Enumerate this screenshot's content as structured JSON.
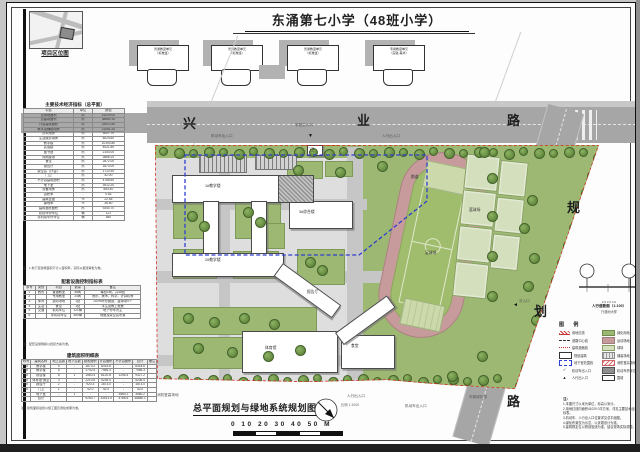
{
  "page_title": "东涌第七小学（48班小学）",
  "location_map": {
    "caption": "项目区位图"
  },
  "roads": {
    "xingye": [
      "兴",
      "业",
      "路"
    ],
    "guihua": [
      "规",
      "划",
      "路"
    ]
  },
  "header_units": {
    "items": [
      {
        "l1": "普通教室单元",
        "l2": "（标准班）"
      },
      {
        "l1": "普通教室单元",
        "l2": "（标准班）"
      },
      {
        "l1": "普通教室单元",
        "l2": "（标准班）"
      },
      {
        "l1": "专用教室单元",
        "l2": "（实验·美术）"
      }
    ]
  },
  "tables": {
    "t1": {
      "title": "主要技术经济指标（总平面）",
      "cols": [
        "项目",
        "单位",
        "数值"
      ],
      "hl": [
        0,
        1,
        2
      ],
      "rows": [
        [
          "总用地面积",
          "㎡",
          "41029.00"
        ],
        [
          "总建筑面积",
          "㎡",
          "38680.10"
        ],
        [
          "计容建筑面积",
          "㎡",
          "33913.50"
        ],
        [
          "教学及辅助用房",
          "㎡",
          "21051.20"
        ],
        [
          "办公用房",
          "㎡",
          "3027.70"
        ],
        [
          "生活服务用房",
          "㎡",
          "8024.60"
        ],
        [
          "教学楼",
          "㎡",
          "10193.80"
        ],
        [
          "实验楼",
          "㎡",
          "4021.50"
        ],
        [
          "图书馆",
          "㎡",
          "2153.00"
        ],
        [
          "风雨操场",
          "㎡",
          "3866.20"
        ],
        [
          "食堂",
          "㎡",
          "2872.00"
        ],
        [
          "报告厅",
          "㎡",
          "1873.00"
        ],
        [
          "架空层（计容）",
          "㎡",
          "1712.90"
        ],
        [
          "门卫",
          "㎡",
          "42.00"
        ],
        [
          "不计容建筑面积",
          "㎡",
          "4766.60"
        ],
        [
          "地下室",
          "㎡",
          "3912.20"
        ],
        [
          "设备用房",
          "㎡",
          "854.40"
        ],
        [
          "容积率",
          "-",
          "0.83"
        ],
        [
          "建筑密度",
          "%",
          "22.55"
        ],
        [
          "绿地率",
          "%",
          "36.60"
        ],
        [
          "建筑基底面积",
          "㎡",
          "9250.70"
        ],
        [
          "机动车停车位",
          "辆",
          "121"
        ],
        [
          "非机动车停车位",
          "辆",
          "480"
        ]
      ],
      "note": "注：1.地下室建筑面积不计入容积率，实际以报建审批为准。"
    },
    "t2": {
      "title": "配套设施控制指标表",
      "cols": [
        "序号",
        "类别",
        "项目",
        "数量",
        "备注"
      ],
      "rows": [
        [
          "1",
          "教育",
          "普通教室",
          "48间",
          "每班1间，共48班"
        ],
        [
          "2",
          "",
          "专用教室",
          "24间",
          "音乐、美术、科学、计算机等"
        ],
        [
          "3",
          "体育",
          "运动场地",
          "1处",
          "200m环形跑道、篮球场4个"
        ],
        [
          "4",
          "生活",
          "食堂",
          "1处",
          "学生及教工就餐"
        ],
        [
          "5",
          "交通",
          "机动车位",
          "121辆",
          "地下停车为主"
        ],
        [
          "6",
          "",
          "非机动车位",
          "480辆",
          "地面及架空层布置"
        ]
      ],
      "note": "注：配套设施规模以批复方案为准。"
    },
    "t3": {
      "title": "建筑面积明细表",
      "cols": [
        "栋号",
        "建筑名称",
        "地上层数",
        "地下层数",
        "基底面积",
        "计容面积",
        "不计容面积",
        "合计",
        "备注"
      ],
      "rows": [
        [
          "1#",
          "教学楼",
          "5",
          "-",
          "1873.2",
          "8315.6",
          "-",
          "8315.6",
          ""
        ],
        [
          "2#",
          "教学楼",
          "5",
          "-",
          "1742.5",
          "7956.3",
          "-",
          "7956.3",
          ""
        ],
        [
          "3#",
          "综合楼",
          "6",
          "1",
          "1560.4",
          "8120.8",
          "1206.4",
          "9327.2",
          ""
        ],
        [
          "4#",
          "体育馆·食堂",
          "3",
          "-",
          "2210.6",
          "5236.4",
          "-",
          "5236.4",
          ""
        ],
        [
          "5#",
          "报告厅",
          "2",
          "-",
          "920.3",
          "1873.0",
          "-",
          "1873.0",
          ""
        ],
        [
          "6#",
          "门卫",
          "1",
          "-",
          "42.0",
          "42.0",
          "-",
          "42.0",
          ""
        ],
        [
          "-",
          "地下室",
          "-",
          "1",
          "-",
          "-",
          "3560.2",
          "3560.2",
          ""
        ],
        [
          "",
          "合计",
          "",
          "",
          "9250.7",
          "33913.5",
          "4766.6",
          "38680.1",
          ""
        ]
      ],
      "note": "注：建筑面积最终以施工图及测绘成果为准。"
    }
  },
  "site": {
    "entrance_marker": "▼",
    "east_marker": "◄",
    "annotations": [
      {
        "x": 288,
        "y": 120,
        "t": "学校主入口"
      },
      {
        "x": 204,
        "y": 131,
        "t": "机动车出入口"
      },
      {
        "x": 375,
        "y": 131,
        "t": "人行出入口"
      },
      {
        "x": 150,
        "y": 390,
        "t": "消防登高场地"
      },
      {
        "x": 340,
        "y": 391,
        "t": "人行出入口"
      },
      {
        "x": 398,
        "y": 401,
        "t": "机动车出入口"
      },
      {
        "x": 462,
        "y": 392,
        "t": "市政绿化带"
      },
      {
        "x": 512,
        "y": 296,
        "t": "次入口"
      }
    ],
    "plan_labels": [
      {
        "x": 198,
        "y": 181,
        "t": "1#教学楼"
      },
      {
        "x": 198,
        "y": 255,
        "t": "2#教学楼"
      },
      {
        "x": 292,
        "y": 207,
        "t": "3#综合楼"
      },
      {
        "x": 258,
        "y": 343,
        "t": "体育馆"
      },
      {
        "x": 344,
        "y": 341,
        "t": "食堂"
      },
      {
        "x": 300,
        "y": 287,
        "t": "报告厅"
      },
      {
        "x": 418,
        "y": 248,
        "t": "足球场"
      },
      {
        "x": 462,
        "y": 205,
        "t": "篮球场"
      },
      {
        "x": 404,
        "y": 172,
        "t": "跑道"
      },
      {
        "x": 300,
        "y": 145,
        "t": "门卫"
      }
    ]
  },
  "section_detail": {
    "caption": "人行道断面（1:100）",
    "sub": "行道树大样",
    "dims": "2.0  2.0  4.0"
  },
  "legend": {
    "title": "图  例",
    "left": [
      {
        "s": "s-redline",
        "l": "用地红线"
      },
      {
        "s": "s-bolddash",
        "l": "道路中心线"
      },
      {
        "s": "s-dots",
        "l": "建筑退缩线"
      },
      {
        "s": "s-rect",
        "l": "规划建筑"
      },
      {
        "s": "s-rectdash",
        "l": "地下室范围线"
      },
      {
        "s": "s-check",
        "l": "机动车出入口"
      },
      {
        "s": "s-arrow",
        "l": "人行出入口"
      }
    ],
    "right": [
      {
        "s": "s-green",
        "l": "绿化用地"
      },
      {
        "s": "s-track",
        "l": "运动场地"
      },
      {
        "s": "s-court",
        "l": "球场"
      },
      {
        "s": "s-grid",
        "l": "铺装场地"
      },
      {
        "s": "s-hatch",
        "l": "消防登高场地"
      },
      {
        "s": "s-dark",
        "l": "机动车停车位"
      },
      {
        "s": "s-rect",
        "l": "围墙"
      }
    ]
  },
  "notes": {
    "title": "注：",
    "lines": [
      "1.本图尺寸以米为单位，标高以米计。",
      "2.用地红线内面积41029.0平方米，详见主要技术经济指标表。",
      "3.机动车、人行出入口位置详见总平面图。",
      "4.绿化布置仅为示意，以景观设计为准。",
      "5.建筑物定位以规划验线为准，结合现场实际调整。"
    ]
  },
  "bottom": {
    "title": "总平面规划与绿地系统规划图",
    "scale_note": "比例 1:1000",
    "scale_digits": "0  10 20 30 40 50 M"
  }
}
